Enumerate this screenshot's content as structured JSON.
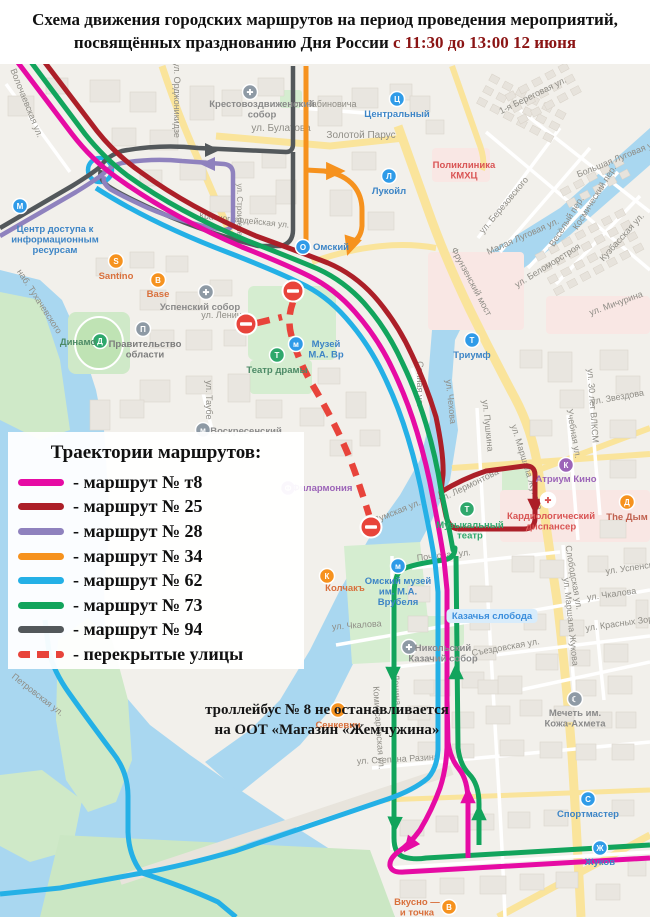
{
  "title": {
    "line1": "Схема движения городских маршрутов на период проведения мероприятий,",
    "line2_black": "посвящённых празднованию Дня России",
    "line2_red": "с 11:30 до 13:00 12 июня"
  },
  "legend": {
    "title": "Траектории маршрутов:",
    "routes": [
      {
        "key": "t8",
        "label": "- маршрут № т8",
        "color": "#E60BA4",
        "dashed": false
      },
      {
        "key": "r25",
        "label": "- маршрут № 25",
        "color": "#AC1F28",
        "dashed": false
      },
      {
        "key": "r28",
        "label": "- маршрут № 28",
        "color": "#8F82BE",
        "dashed": false
      },
      {
        "key": "r34",
        "label": "- маршрут № 34",
        "color": "#F6921E",
        "dashed": false
      },
      {
        "key": "r62",
        "label": "- маршрут № 62",
        "color": "#24B0E6",
        "dashed": false
      },
      {
        "key": "r73",
        "label": "- маршрут № 73",
        "color": "#12A45C",
        "dashed": false
      },
      {
        "key": "r94",
        "label": "- маршрут № 94",
        "color": "#53585B",
        "dashed": false
      },
      {
        "key": "closed",
        "label": "- перекрытые улицы",
        "color": "#E8443B",
        "dashed": true
      }
    ]
  },
  "note": {
    "line1": "троллейбус № 8 не останавливается",
    "line2": "на ООТ «Магазин «Жемчужина»"
  },
  "map": {
    "street_labels": [
      {
        "t": "Волочаевская ул.",
        "x": 24,
        "y": 104,
        "r": 68
      },
      {
        "t": "ул. Орджоникидзе",
        "x": 174,
        "y": 100,
        "r": 90
      },
      {
        "t": "ул. Рабиновича",
        "x": 324,
        "y": 107,
        "r": 0
      },
      {
        "t": "ул. Булатова",
        "x": 281,
        "y": 131,
        "r": 0,
        "s": 10
      },
      {
        "t": "Золотой Парус",
        "x": 361,
        "y": 138,
        "r": 0,
        "s": 10,
        "c": "#9A9A94"
      },
      {
        "t": "1-я Береговая ул.",
        "x": 534,
        "y": 98,
        "r": -26
      },
      {
        "t": "Большая Луговая ул.",
        "x": 619,
        "y": 161,
        "r": -22
      },
      {
        "t": "ул. Березовского",
        "x": 506,
        "y": 207,
        "r": -50
      },
      {
        "t": "Космический пер.",
        "x": 597,
        "y": 199,
        "r": -58
      },
      {
        "t": "Весёлый пер.",
        "x": 569,
        "y": 223,
        "r": -58
      },
      {
        "t": "Малая Луговая ул.",
        "x": 524,
        "y": 239,
        "r": -24
      },
      {
        "t": "Кузбасская ул.",
        "x": 624,
        "y": 239,
        "r": -48
      },
      {
        "t": "ул. Мичурина",
        "x": 617,
        "y": 306,
        "r": -20
      },
      {
        "t": "ул. Беломорстроя",
        "x": 549,
        "y": 268,
        "r": -32
      },
      {
        "t": "Фрунзенский мост",
        "x": 469,
        "y": 283,
        "r": 62
      },
      {
        "t": "наб. Тухачевского",
        "x": 37,
        "y": 303,
        "r": 57
      },
      {
        "t": "ул. Строителей",
        "x": 237,
        "y": 212,
        "r": 90,
        "s": 8
      },
      {
        "t": "Красногвардейская ул.",
        "x": 244,
        "y": 223,
        "r": 6,
        "s": 8.5
      },
      {
        "t": "ул. Ленина",
        "x": 224,
        "y": 318,
        "r": 0
      },
      {
        "t": "Сенная ул.",
        "x": 417,
        "y": 384,
        "r": 90
      },
      {
        "t": "ул. Таубе",
        "x": 206,
        "y": 400,
        "r": 90
      },
      {
        "t": "ул. Чехова",
        "x": 448,
        "y": 402,
        "r": 84
      },
      {
        "t": "ул. Пушкина",
        "x": 485,
        "y": 426,
        "r": 84
      },
      {
        "t": "ул. Маршала Жукова",
        "x": 524,
        "y": 468,
        "r": 73
      },
      {
        "t": "ул. Маршала Жукова",
        "x": 568,
        "y": 622,
        "r": 84
      },
      {
        "t": "ул. Звездова",
        "x": 618,
        "y": 400,
        "r": -10
      },
      {
        "t": "ул. 30 лет ВЛКСМ",
        "x": 590,
        "y": 406,
        "r": 86
      },
      {
        "t": "Учебная ул.",
        "x": 571,
        "y": 434,
        "r": 80
      },
      {
        "t": "ул. Лермонтова",
        "x": 470,
        "y": 488,
        "r": -26
      },
      {
        "t": "Думская ул.",
        "x": 398,
        "y": 514,
        "r": -22
      },
      {
        "t": "Почтовая ул.",
        "x": 444,
        "y": 558,
        "r": -6
      },
      {
        "t": "ул. Чкалова",
        "x": 357,
        "y": 628,
        "r": -4
      },
      {
        "t": "ул. Чкалова",
        "x": 612,
        "y": 597,
        "r": -8
      },
      {
        "t": "Съездовская ул.",
        "x": 506,
        "y": 650,
        "r": -10
      },
      {
        "t": "Слободская ул.",
        "x": 571,
        "y": 578,
        "r": 80
      },
      {
        "t": "ул. Успенского",
        "x": 636,
        "y": 570,
        "r": -8
      },
      {
        "t": "ул. Красных Зорь",
        "x": 622,
        "y": 626,
        "r": -8
      },
      {
        "t": "Комиссаровская ул.",
        "x": 376,
        "y": 728,
        "r": 86
      },
      {
        "t": "ул. Степана Разина",
        "x": 398,
        "y": 762,
        "r": -3
      },
      {
        "t": "Ленина",
        "x": 394,
        "y": 690,
        "r": 86
      },
      {
        "t": "Петровская ул.",
        "x": 36,
        "y": 697,
        "r": 38
      }
    ],
    "pois": [
      {
        "name": "Крестовоздвиженский собор",
        "icon": {
          "x": 250,
          "y": 92,
          "bg": "#8E9AA5",
          "g": "✚"
        },
        "label": {
          "x": 262,
          "y": 107,
          "lines": [
            "Крестовоздвиженский",
            "собор"
          ],
          "c": "#8A8A8A"
        }
      },
      {
        "name": "Центральный",
        "icon": {
          "x": 397,
          "y": 99,
          "bg": "#2F9BE8",
          "g": "Ц"
        },
        "label": {
          "x": 397,
          "y": 117,
          "lines": [
            "Центральный"
          ],
          "c": "#3D85C6"
        }
      },
      {
        "name": "Лукойл",
        "icon": {
          "x": 389,
          "y": 176,
          "bg": "#2F9BE8",
          "g": "Л"
        },
        "label": {
          "x": 389,
          "y": 194,
          "lines": [
            "Лукойл"
          ],
          "c": "#3D85C6"
        }
      },
      {
        "name": "Поликлиника КМХЦ",
        "icon": null,
        "label": {
          "x": 464,
          "y": 168,
          "lines": [
            "Поликлиника",
            "КМХЦ"
          ],
          "c": "#D95454"
        }
      },
      {
        "name": "Омский",
        "icon": {
          "x": 303,
          "y": 247,
          "bg": "#2F9BE8",
          "g": "О"
        },
        "label": {
          "x": 331,
          "y": 250,
          "lines": [
            "Омский"
          ],
          "c": "#3D85C6"
        }
      },
      {
        "name": "Santino",
        "icon": {
          "x": 116,
          "y": 261,
          "bg": "#F6921E",
          "g": "S"
        },
        "label": {
          "x": 116,
          "y": 279,
          "lines": [
            "Santino"
          ],
          "c": "#D9703C"
        }
      },
      {
        "name": "Base",
        "icon": {
          "x": 158,
          "y": 280,
          "bg": "#F6921E",
          "g": "B"
        },
        "label": {
          "x": 158,
          "y": 297,
          "lines": [
            "Base"
          ],
          "c": "#D9703C"
        }
      },
      {
        "name": "Успенский собор",
        "icon": {
          "x": 206,
          "y": 292,
          "bg": "#8E9AA5",
          "g": "✚"
        },
        "label": {
          "x": 200,
          "y": 310,
          "lines": [
            "Успенский собор"
          ],
          "c": "#8A8A8A"
        }
      },
      {
        "name": "Центр доступа к информационным ресурсам",
        "icon": {
          "x": 20,
          "y": 206,
          "bg": "#2F9BE8",
          "g": "М"
        },
        "label": {
          "x": 55,
          "y": 232,
          "lines": [
            "Центр доступа к",
            "информационным",
            "ресурсам"
          ],
          "c": "#3D85C6"
        }
      },
      {
        "name": "Театр драмы",
        "icon": {
          "x": 277,
          "y": 355,
          "bg": "#2FA86C",
          "g": "Т"
        },
        "label": {
          "x": 277,
          "y": 373,
          "lines": [
            "Театр драмы"
          ],
          "c": "#4C8A66"
        }
      },
      {
        "name": "Музей М.А. Врубеля",
        "icon": {
          "x": 296,
          "y": 344,
          "bg": "#2F9BE8",
          "g": "м"
        },
        "label": {
          "x": 326,
          "y": 347,
          "lines": [
            "Музей",
            "М.А. Вр"
          ],
          "c": "#3D85C6"
        }
      },
      {
        "name": "Динамо",
        "icon": {
          "x": 100,
          "y": 341,
          "bg": "#2FA86C",
          "g": "Д"
        },
        "label": {
          "x": 78,
          "y": 345,
          "lines": [
            "Динамо"
          ],
          "c": "#4C8A66"
        }
      },
      {
        "name": "Правительство области",
        "icon": {
          "x": 143,
          "y": 329,
          "bg": "#8E9AA5",
          "g": "П"
        },
        "label": {
          "x": 145,
          "y": 347,
          "lines": [
            "Правительство",
            "области"
          ],
          "c": "#7C7C7C"
        }
      },
      {
        "name": "Воскресенский",
        "icon": {
          "x": 203,
          "y": 430,
          "bg": "#8E9AA5",
          "g": "м"
        },
        "label": {
          "x": 246,
          "y": 434,
          "lines": [
            "Воскресенский"
          ],
          "c": "#8A8A8A"
        }
      },
      {
        "name": "Филармония",
        "icon": {
          "x": 288,
          "y": 488,
          "bg": "#9C64B8",
          "g": "Ф"
        },
        "label": {
          "x": 322,
          "y": 491,
          "lines": [
            "Филармония"
          ],
          "c": "#9C64B8"
        }
      },
      {
        "name": "Триумф",
        "icon": {
          "x": 472,
          "y": 340,
          "bg": "#2F9BE8",
          "g": "Т"
        },
        "label": {
          "x": 472,
          "y": 358,
          "lines": [
            "Триумф"
          ],
          "c": "#3D85C6"
        }
      },
      {
        "name": "Музыкальный театр",
        "icon": {
          "x": 467,
          "y": 509,
          "bg": "#2FA86C",
          "g": "Т"
        },
        "label": {
          "x": 470,
          "y": 528,
          "lines": [
            "Музыкальный",
            "театр"
          ],
          "c": "#2FA86C"
        }
      },
      {
        "name": "Атриум Кино",
        "icon": {
          "x": 566,
          "y": 465,
          "bg": "#9C64B8",
          "g": "К"
        },
        "label": {
          "x": 566,
          "y": 482,
          "lines": [
            "Атриум Кино"
          ],
          "c": "#9C64B8"
        }
      },
      {
        "name": "Кардиологический диспансер",
        "icon": {
          "x": 548,
          "y": 500,
          "bg": "#FFFFFF",
          "g": "✚",
          "fg": "#D95454"
        },
        "label": {
          "x": 551,
          "y": 519,
          "lines": [
            "Кардиологический",
            "диспансер"
          ],
          "c": "#D95454"
        }
      },
      {
        "name": "The Дым",
        "icon": {
          "x": 627,
          "y": 502,
          "bg": "#F6921E",
          "g": "Д"
        },
        "label": {
          "x": 627,
          "y": 520,
          "lines": [
            "The Дым"
          ],
          "c": "#C0614F"
        }
      },
      {
        "name": "Колчакъ",
        "icon": {
          "x": 327,
          "y": 576,
          "bg": "#F6921E",
          "g": "К"
        },
        "label": {
          "x": 345,
          "y": 591,
          "lines": [
            "Колчакъ"
          ],
          "c": "#D9703C"
        }
      },
      {
        "name": "Омский музей им. М.А. Врубеля",
        "icon": {
          "x": 398,
          "y": 566,
          "bg": "#2F9BE8",
          "g": "м"
        },
        "label": {
          "x": 398,
          "y": 584,
          "lines": [
            "Омский музей",
            "им. М.А.",
            "Врубеля"
          ],
          "c": "#3D85C6"
        }
      },
      {
        "name": "Никольский Казачий собор",
        "icon": {
          "x": 409,
          "y": 647,
          "bg": "#8E9AA5",
          "g": "✚"
        },
        "label": {
          "x": 443,
          "y": 651,
          "lines": [
            "Никольский",
            "Казачий собор"
          ],
          "c": "#8A8A8A"
        }
      },
      {
        "name": "Казачья слобода",
        "icon": null,
        "pill": true,
        "label": {
          "x": 492,
          "y": 619,
          "lines": [
            "Казачья слобода"
          ],
          "c": "#3B8EDC"
        }
      },
      {
        "name": "Мечеть им. Кожа-Ахмета",
        "icon": {
          "x": 575,
          "y": 699,
          "bg": "#8E9AA5",
          "g": "☾"
        },
        "label": {
          "x": 575,
          "y": 716,
          "lines": [
            "Мечеть им.",
            "Кожа-Ахмета"
          ],
          "c": "#8A8A8A"
        }
      },
      {
        "name": "Сенкевич",
        "icon": {
          "x": 338,
          "y": 710,
          "bg": "#F6921E",
          "g": "С"
        },
        "label": {
          "x": 338,
          "y": 728,
          "lines": [
            "Сенкевич"
          ],
          "c": "#D9703C"
        }
      },
      {
        "name": "Спортмастер",
        "icon": {
          "x": 588,
          "y": 799,
          "bg": "#2F9BE8",
          "g": "С"
        },
        "label": {
          "x": 588,
          "y": 817,
          "lines": [
            "Спортмастер"
          ],
          "c": "#3D85C6"
        }
      },
      {
        "name": "Жуков",
        "icon": {
          "x": 600,
          "y": 848,
          "bg": "#2F9BE8",
          "g": "Ж"
        },
        "label": {
          "x": 600,
          "y": 865,
          "lines": [
            "Жуков"
          ],
          "c": "#3D85C6"
        }
      },
      {
        "name": "Вкусно — и точка",
        "icon": {
          "x": 449,
          "y": 907,
          "bg": "#F6921E",
          "g": "В"
        },
        "label": {
          "x": 417,
          "y": 905,
          "lines": [
            "Вкусно —",
            "и точка"
          ],
          "c": "#D9703C"
        }
      }
    ]
  }
}
